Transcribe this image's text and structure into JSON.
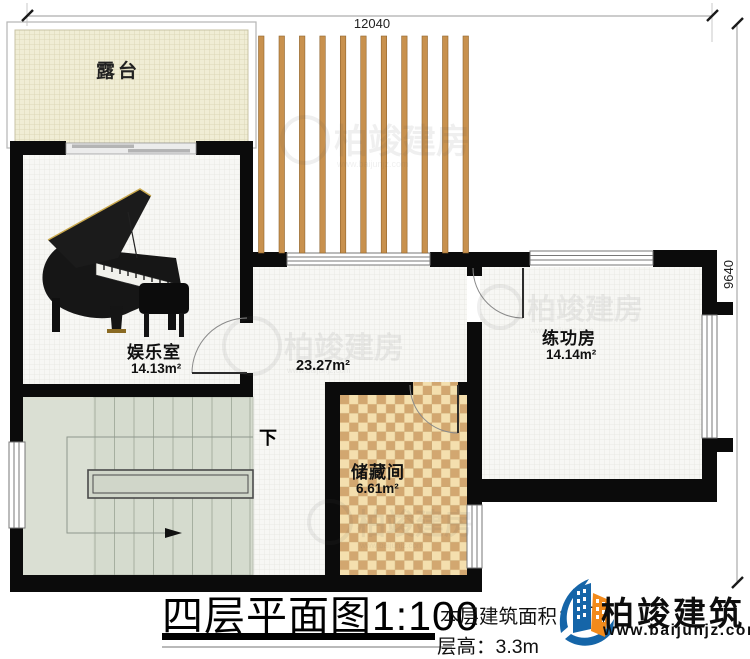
{
  "dimensions": {
    "top": "12040",
    "right": "9640"
  },
  "rooms": {
    "terrace": {
      "name": "露台"
    },
    "entertainment": {
      "name": "娱乐室",
      "area": "14.13m²"
    },
    "hall": {
      "area": "23.27m²"
    },
    "practice": {
      "name": "练功房",
      "area": "14.14m²"
    },
    "storage": {
      "name": "储藏间",
      "area": "6.61m²"
    },
    "stairs": {
      "down_label": "下"
    }
  },
  "title_block": {
    "title": "四层平面图",
    "scale": "1:100",
    "area_label": "本层建筑面积：",
    "area_visible_digit": "7",
    "area_unit": "m²",
    "floor_height": "层高：3.3m"
  },
  "branding": {
    "company": "柏竣建筑",
    "website": "www.baijunjz.com"
  },
  "watermark": {
    "text": "柏竣建房",
    "subtext": "www.baijunjz.com"
  },
  "colors": {
    "wall": "#0b0b0b",
    "terrace_floor": "#f0edd5",
    "pergola_slat": "#c8914e",
    "checker_light": "#f4dfae",
    "checker_dark": "#d2a770",
    "stair_floor": "#d5dbce",
    "logo_blue": "#1565a8",
    "logo_orange": "#f28a1b"
  }
}
